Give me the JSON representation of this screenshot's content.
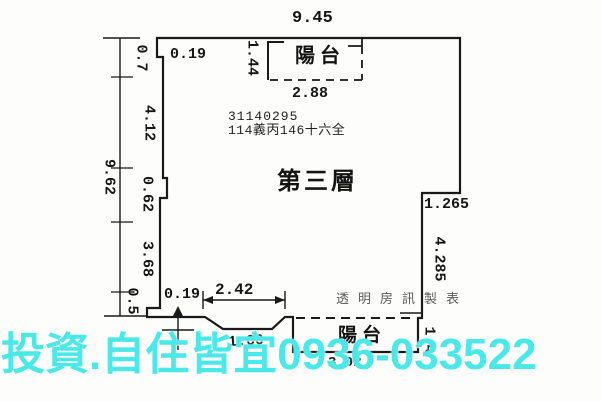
{
  "floorplan": {
    "floor_label": "第三層",
    "serial_number": "31140295",
    "lot_number": "114義丙146十六全",
    "top_balcony_label": "陽台",
    "bottom_balcony_label": "陽台",
    "watermark_producer": "透明房訊製表",
    "watermark_ad": "投資.自住皆宜0936-033522",
    "dimensions": {
      "top_width": "9.45",
      "top_balcony_width": "2.88",
      "top_balcony_depth": "1.44",
      "top_left_offset": "0.19",
      "left_total": "9.62",
      "left_seg_1": "0.7",
      "left_seg_2": "4.12",
      "left_seg_3": "0.62",
      "left_seg_4": "3.68",
      "left_seg_5": "0.5",
      "right_step": "1.265",
      "right_side": "4.285",
      "right_balcony_depth": "1.4",
      "bottom_offset": "0.19",
      "bottom_span": "2.42",
      "bottom_recess": "1.60",
      "bottom_balcony_width": "3.92"
    },
    "colors": {
      "line": "#1a1a1a",
      "ad_watermark": "#4AE8E6",
      "producer_watermark": "#5a5a5a"
    }
  }
}
